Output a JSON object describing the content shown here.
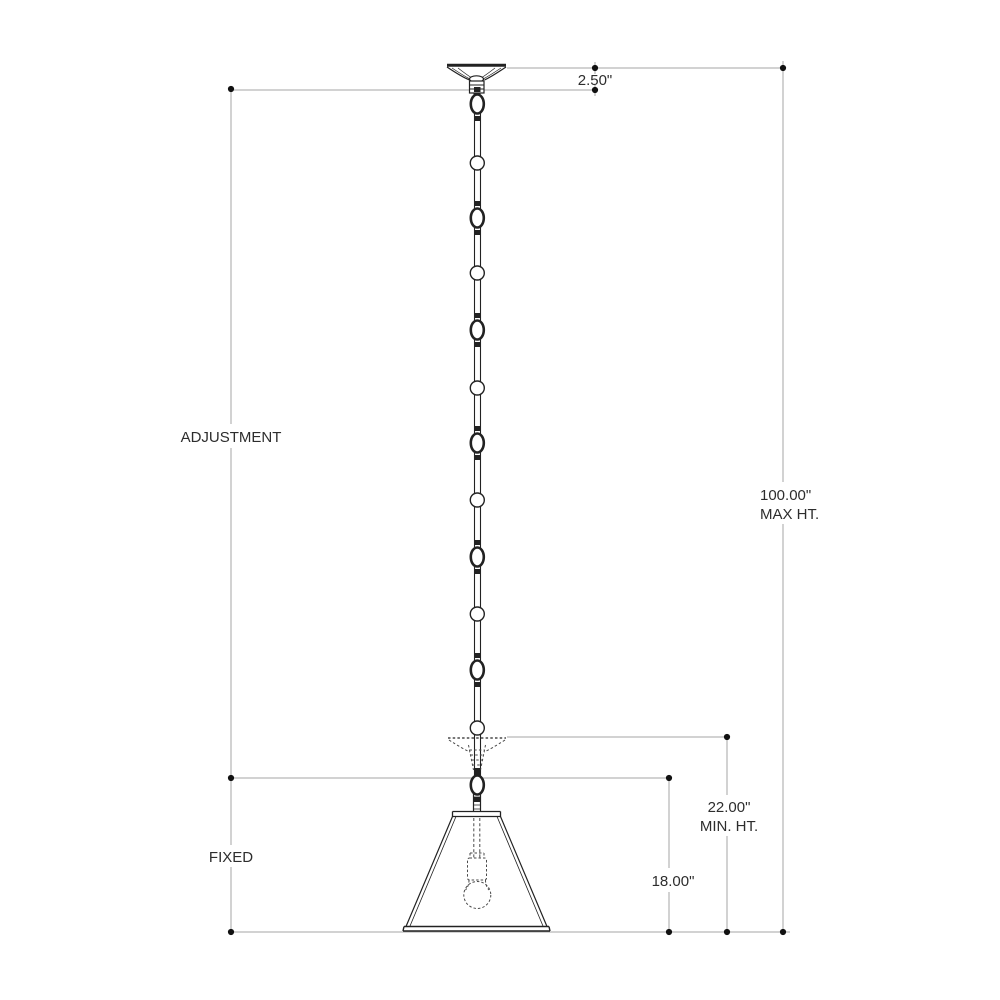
{
  "drawing": {
    "kind": "pendant-light-dimension-drawing",
    "labels": {
      "adjustment": "ADJUSTMENT",
      "fixed": "FIXED"
    },
    "dimensions": {
      "canopy_height": "2.50\"",
      "max_height": {
        "value": "100.00\"",
        "label": "MAX HT."
      },
      "min_height": {
        "value": "22.00\"",
        "label": "MIN. HT."
      },
      "fixture_height": "18.00\""
    },
    "colors": {
      "background": "#ffffff",
      "line_art": "#222222",
      "hidden_lines": "#4a4a4a",
      "dimension_lines": "#a6a6a6",
      "text": "#2d2d2d",
      "endpoint_dots": "#111111"
    }
  }
}
